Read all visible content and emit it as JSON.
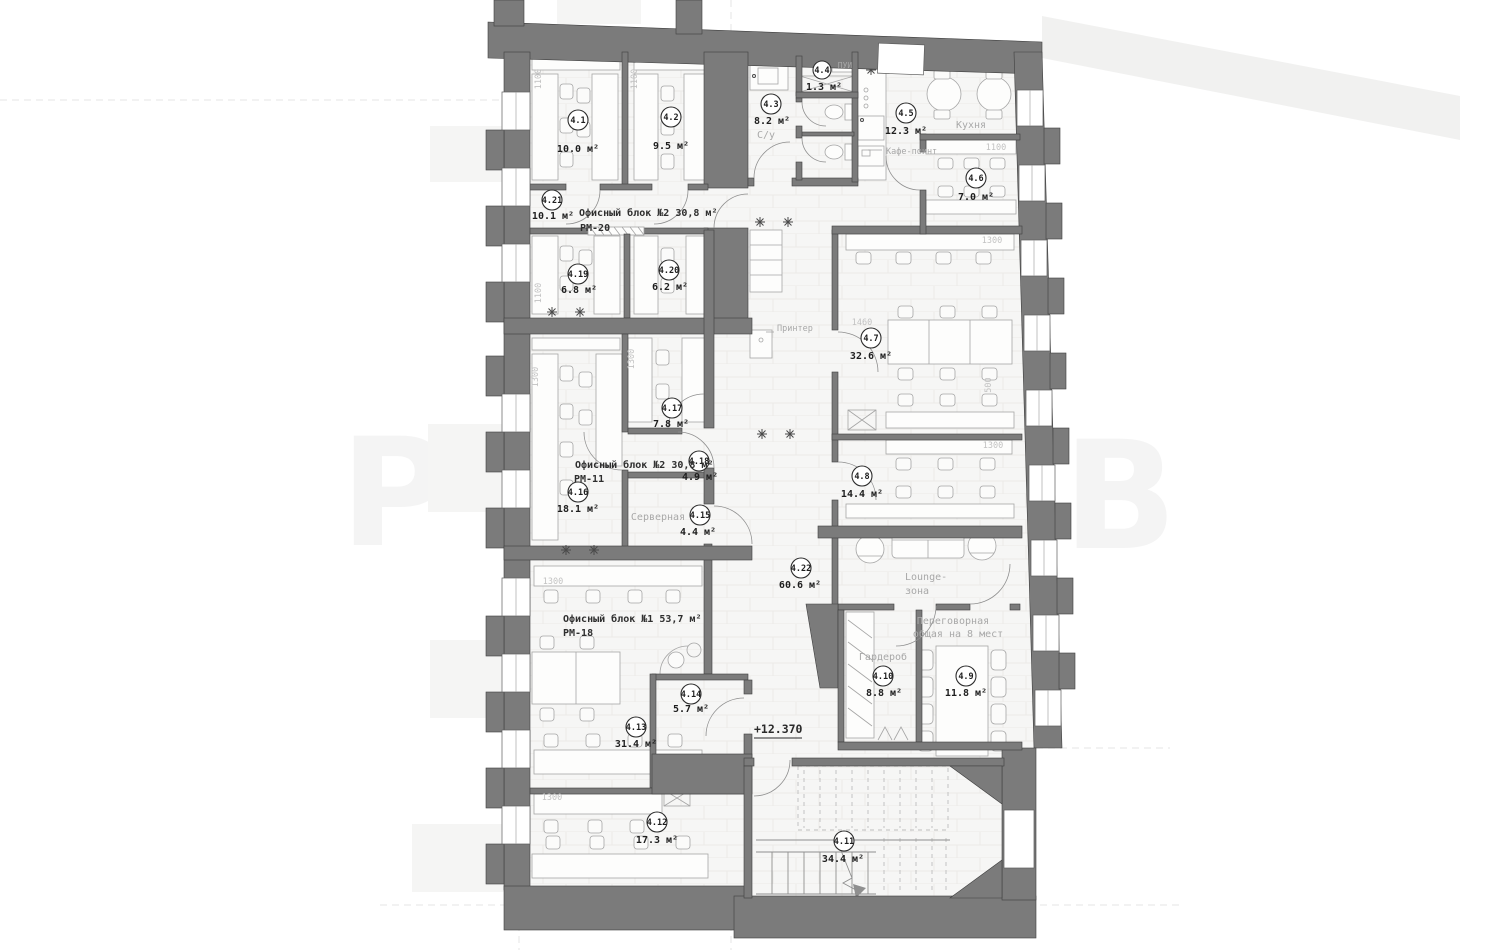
{
  "drawing": {
    "level_mark": "+12.370",
    "watermark": {
      "left": "Р",
      "right": "В"
    },
    "blocks": [
      {
        "title": "Офисный блок №2 30,8 м²",
        "sub": "РМ-20"
      },
      {
        "title": "Офисный блок №2 30,8 м²",
        "sub": "РМ-11"
      },
      {
        "title": "Офисный блок №1 53,7 м²",
        "sub": "РМ-18"
      }
    ],
    "labels": {
      "cafe_point": "Кафе-поинт",
      "printer": "Принтер",
      "lounge_line1": "Lounge-",
      "lounge_line2": "зона"
    },
    "rooms": [
      {
        "number": "4.1",
        "area": "10.0 м²"
      },
      {
        "number": "4.2",
        "area": "9.5 м²"
      },
      {
        "number": "4.3",
        "area": "8.2 м²",
        "name": "С/у"
      },
      {
        "number": "4.4",
        "area": "1.3 м²",
        "name": "ПУИ"
      },
      {
        "number": "4.5",
        "area": "12.3 м²",
        "name": "Кухня"
      },
      {
        "number": "4.6",
        "area": "7.0 м²"
      },
      {
        "number": "4.7",
        "area": "32.6 м²"
      },
      {
        "number": "4.8",
        "area": "14.4 м²"
      },
      {
        "number": "4.9",
        "area": "11.8 м²",
        "name_line1": "Переговорная",
        "name_line2": "общая на 8 мест"
      },
      {
        "number": "4.10",
        "area": "8.8 м²",
        "name": "Гардероб"
      },
      {
        "number": "4.11",
        "area": "34.4 м²"
      },
      {
        "number": "4.12",
        "area": "17.3 м²"
      },
      {
        "number": "4.13",
        "area": "31.4 м²"
      },
      {
        "number": "4.14",
        "area": "5.7 м²"
      },
      {
        "number": "4.15",
        "area": "4.4 м²",
        "name": "Серверная"
      },
      {
        "number": "4.16",
        "area": "18.1 м²"
      },
      {
        "number": "4.17",
        "area": "7.8 м²"
      },
      {
        "number": "4.18",
        "area": "4.9 м²"
      },
      {
        "number": "4.19",
        "area": "6.8 м²"
      },
      {
        "number": "4.20",
        "area": "6.2 м²"
      },
      {
        "number": "4.21",
        "area": "10.1 м²"
      },
      {
        "number": "4.22",
        "area": "60.6 м²"
      }
    ],
    "dims": [
      "1100",
      "1100",
      "1100",
      "1100",
      "1300",
      "1300",
      "1300",
      "1300",
      "1300",
      "1300",
      "1460",
      "500"
    ]
  }
}
